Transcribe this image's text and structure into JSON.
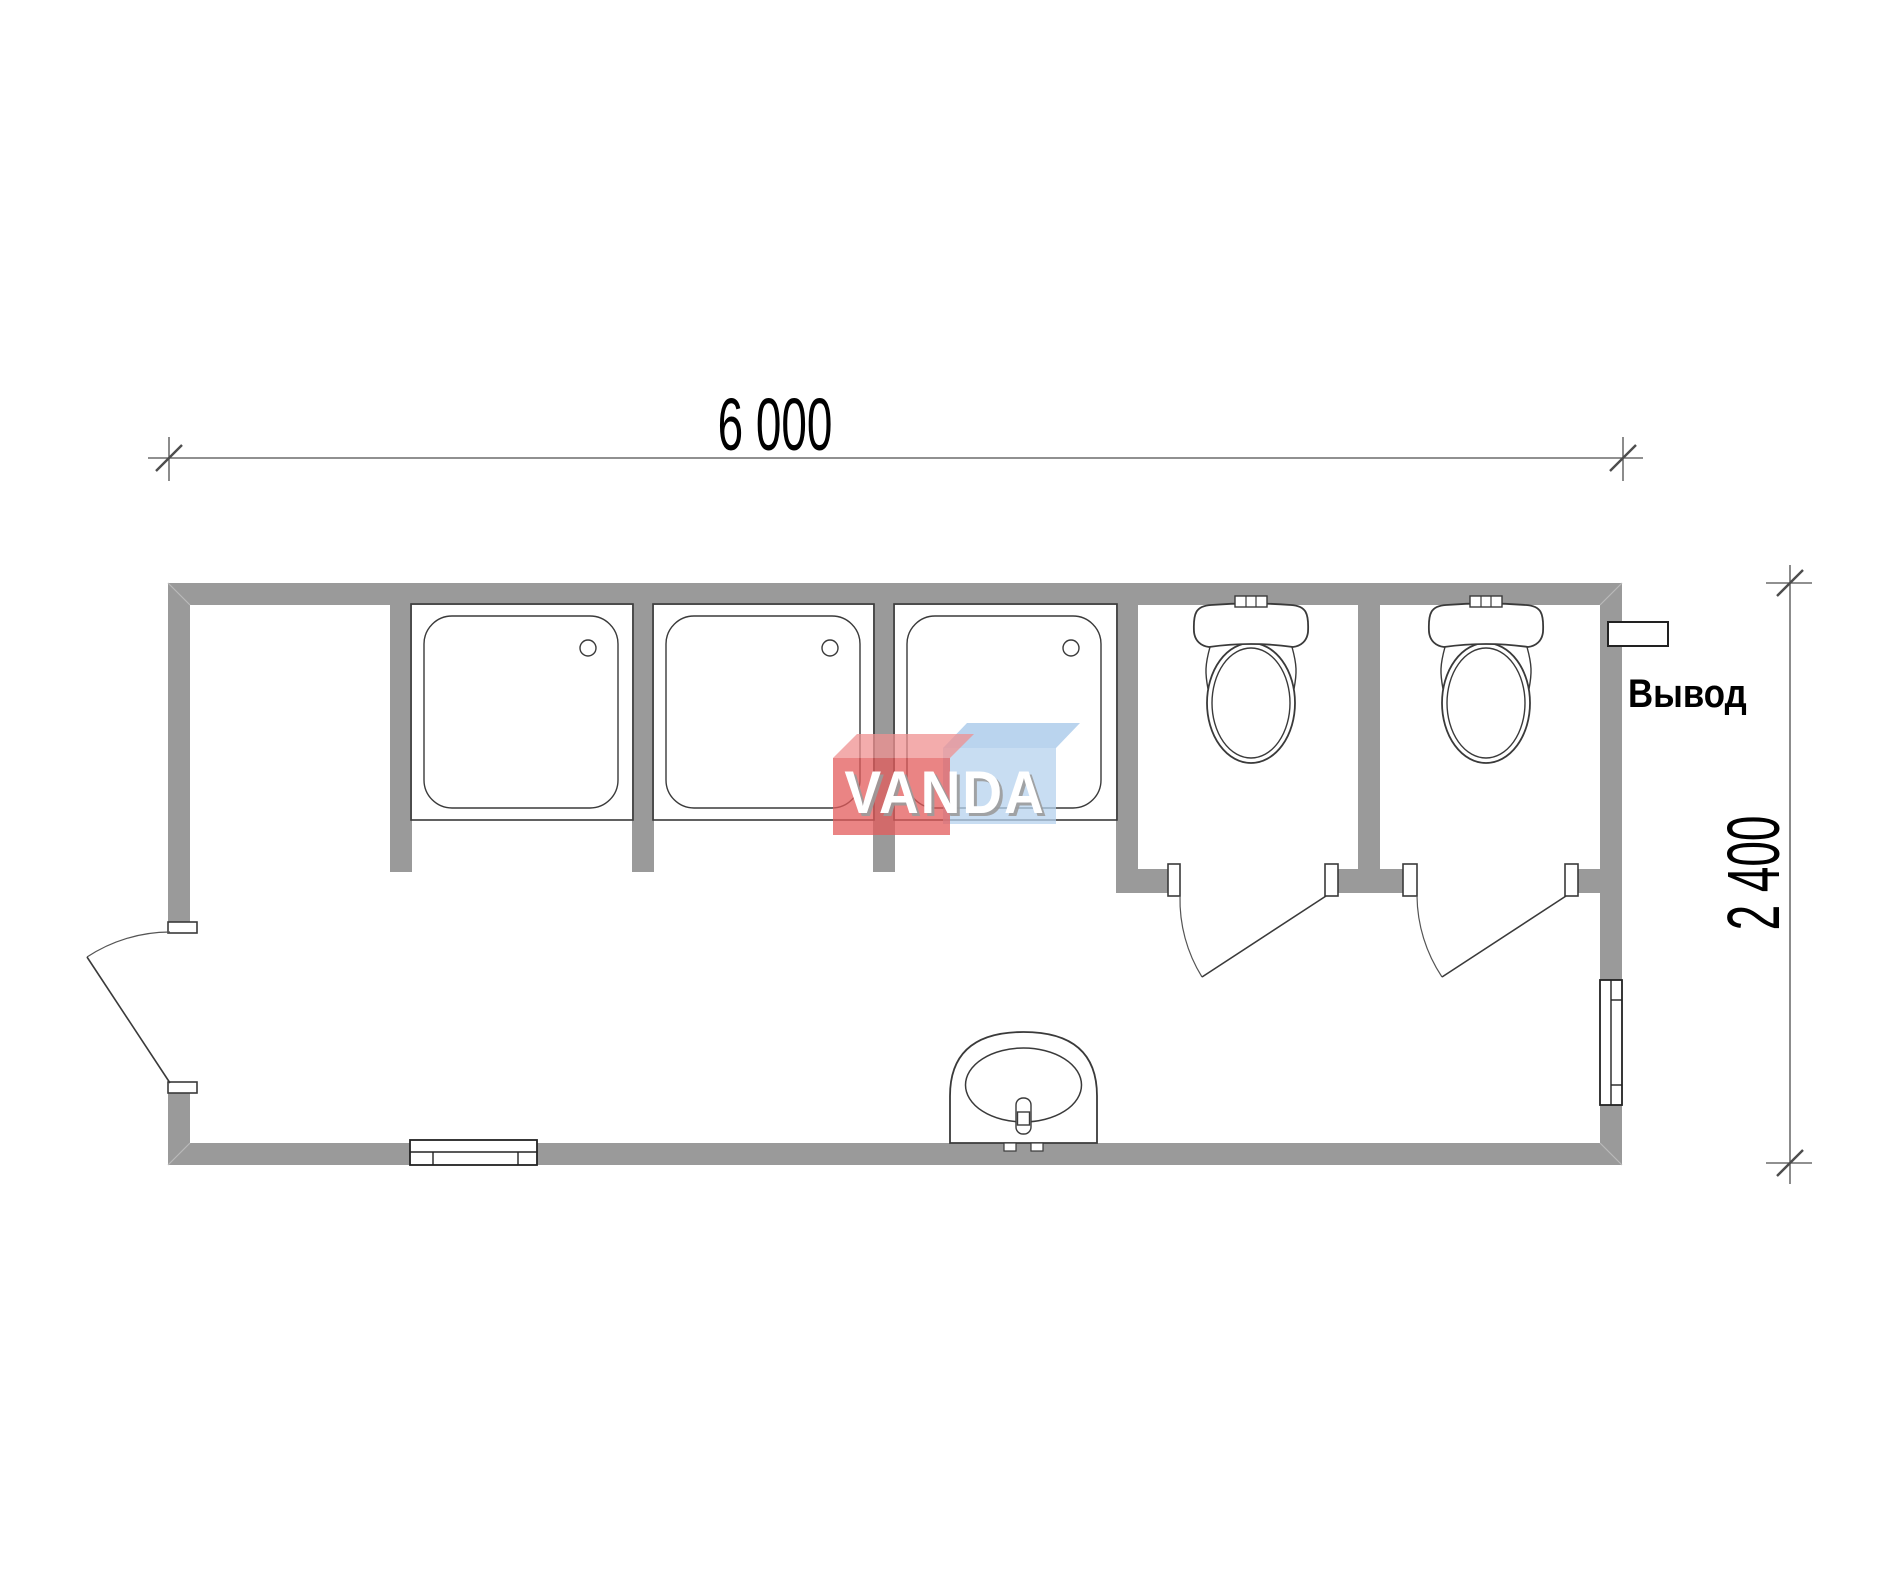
{
  "page": {
    "background": "#ffffff"
  },
  "colors": {
    "wall": "#9a9a9a",
    "line": "#3a3a3a",
    "window_line": "#222222",
    "dim": "#4d4d4d",
    "text": "#000000",
    "watermark_red_front": "#e35b5b",
    "watermark_red_top": "#ef9090",
    "watermark_blue_front": "#b5d2ee",
    "watermark_blue_top": "#a3c6e8",
    "watermark_text": "#ffffff",
    "watermark_text_shadow": "#9b9b9b"
  },
  "dimensions": {
    "width_mm": "6 000",
    "height_mm": "2 400"
  },
  "labels": {
    "outlet": "Вывод"
  },
  "watermark": {
    "text": "VANDA"
  }
}
